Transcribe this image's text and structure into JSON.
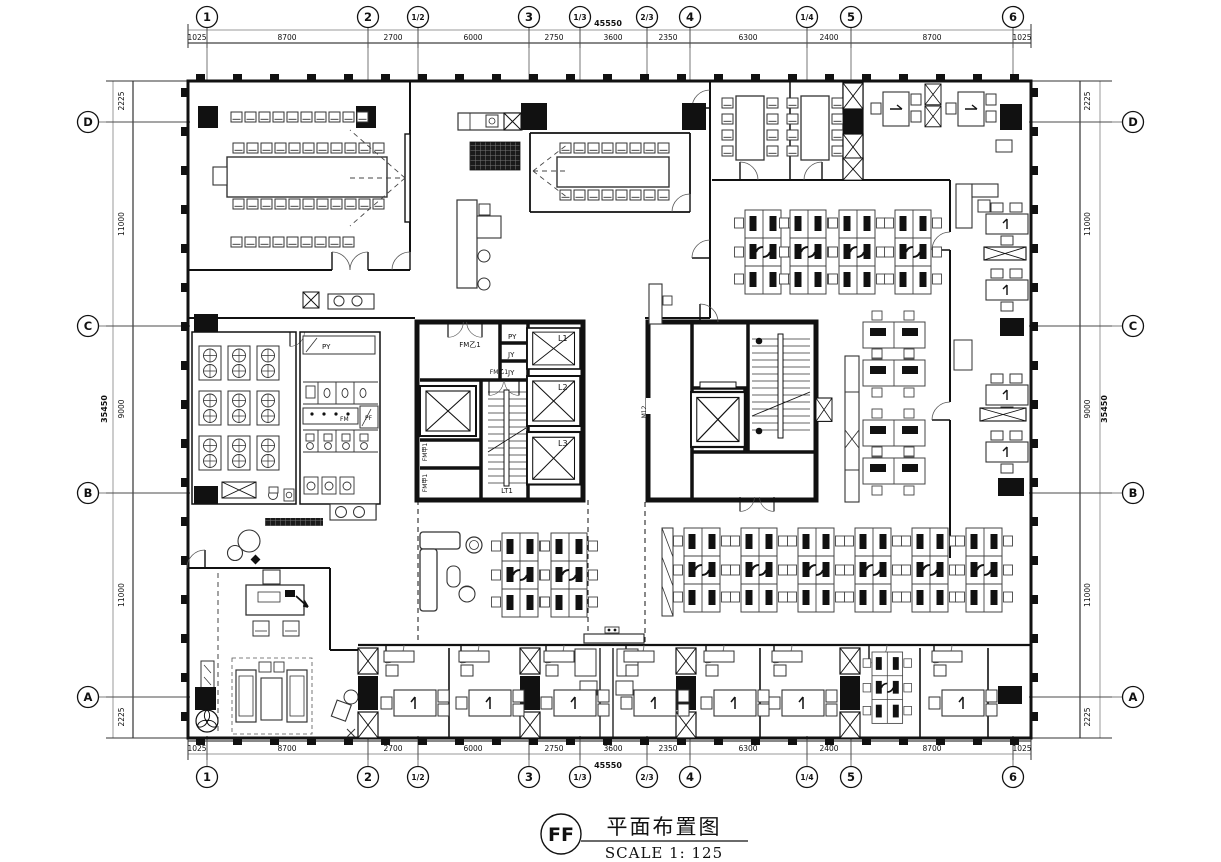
{
  "title_block": {
    "tag": "FF",
    "title": "平面布置图",
    "scale": "SCALE 1: 125"
  },
  "grid": {
    "col_labels": [
      "1",
      "2",
      "1/2",
      "3",
      "1/3",
      "2/3",
      "4",
      "1/4",
      "5",
      "6"
    ],
    "col_dims": [
      "1025",
      "8700",
      "2700",
      "6000",
      "2750",
      "3600",
      "2350",
      "6300",
      "2400",
      "8700",
      "1025"
    ],
    "col_total": "45550",
    "row_labels": [
      "D",
      "C",
      "B",
      "A"
    ],
    "row_dims": [
      "2225",
      "11000",
      "9000",
      "11000",
      "2225"
    ],
    "row_total": "35450"
  },
  "labels": {
    "fm_b1_top": "FM乙1",
    "fm_b1_stair": "FM乙1",
    "fm_a1_upper": "FM甲1",
    "fm_a1_lower": "FM甲1",
    "shaft_py": "PY",
    "shaft_jy1": "JY",
    "shaft_jy2": "JY",
    "lift_l1": "L1",
    "lift_l2": "L2",
    "lift_l3": "L3",
    "stair_lt1": "LT1",
    "door_m12": "M12",
    "wc_py": "PY",
    "wc_pf": "PF",
    "wc_fm": "FM"
  }
}
